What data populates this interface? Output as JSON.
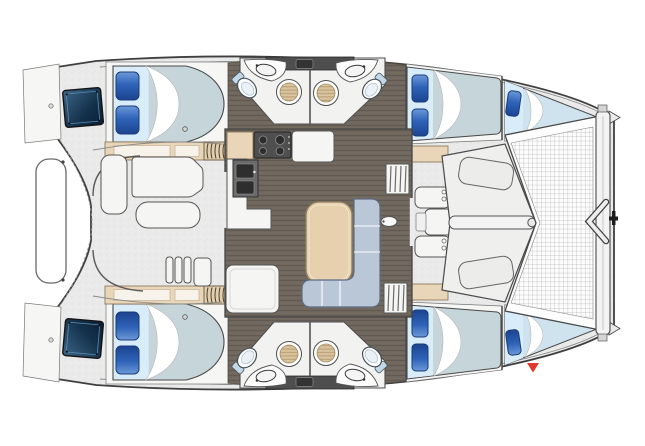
{
  "meta": {
    "type": "boat-deck-plan",
    "vessel": "sailing-catamaran",
    "view": "top-down",
    "bow_direction": "right",
    "visible_text": ""
  },
  "colors": {
    "bg": "#ffffff",
    "deck": "#eaeaea",
    "deck-light": "#f4f4f3",
    "outline": "#3f3f3f",
    "wall": "#4a4a4a",
    "wood": "#6f675d",
    "wood-grain": "#5e564c",
    "wood-grain-light": "#7b7368",
    "tan": "#e9d6b8",
    "tan-dark": "#8d7b5c",
    "table-top": "#e6d0ae",
    "table-edge": "#94815f",
    "sofa": "#bac7d7",
    "sofa-line": "#5e6e84",
    "mattress": "#c6d5d9",
    "sheet-blue": "#d8ecfa",
    "berth-blue": "#cfe3ee",
    "pillow-blue": "#2f63b8",
    "pillow-dark": "#173d77",
    "counter-dark": "#6a6a6a",
    "appliance": "#4f4f4f",
    "basin": "#2e2e2e",
    "shower-tan": "#d9c49f",
    "shower-stripe": "#b89c72",
    "hatch-blue-1": "#3d6688",
    "hatch-blue-2": "#0a1f33",
    "net-line": "#8f8f8f",
    "toilet-tank": "#c3d7e6",
    "marker-red": "#e2382a"
  },
  "plan": {
    "decks": [
      "aft-cockpit",
      "salon",
      "forward-cockpit",
      "foredeck",
      "trampoline"
    ],
    "cabins": [
      {
        "id": "port-aft-cabin",
        "berth": "double",
        "pillows": 2
      },
      {
        "id": "starboard-aft-cabin",
        "berth": "double",
        "pillows": 2
      },
      {
        "id": "port-forward-cabin",
        "berth": "double",
        "pillows": 2
      },
      {
        "id": "starboard-forward-cabin",
        "berth": "double",
        "pillows": 2
      },
      {
        "id": "port-forepeak-berth",
        "berth": "single",
        "pillows": 1
      },
      {
        "id": "starboard-forepeak-berth",
        "berth": "single",
        "pillows": 1
      }
    ],
    "heads": [
      {
        "id": "port-aft-head",
        "fixtures": [
          "toilet",
          "sink",
          "shower"
        ]
      },
      {
        "id": "port-forward-head",
        "fixtures": [
          "toilet",
          "sink",
          "shower"
        ]
      },
      {
        "id": "starboard-aft-head",
        "fixtures": [
          "toilet",
          "sink",
          "shower"
        ]
      },
      {
        "id": "starboard-forward-head",
        "fixtures": [
          "toilet",
          "sink",
          "shower"
        ]
      }
    ],
    "salon": {
      "furniture": [
        "galley-stove",
        "galley-sink",
        "galley-counters",
        "dining-table",
        "l-shaped-sofa",
        "companionway-steps"
      ]
    },
    "cockpit": {
      "furniture": [
        "cockpit-table",
        "l-bench",
        "side-bench",
        "transom-steps",
        "swim-platforms",
        "engine-hatches",
        "davit-rail"
      ]
    },
    "bow": {
      "features": [
        "trampoline-net",
        "crossbeam",
        "seagull-striker",
        "bow-roller"
      ]
    },
    "marker": {
      "shape": "triangle-down",
      "color_ref": "marker-red"
    }
  }
}
